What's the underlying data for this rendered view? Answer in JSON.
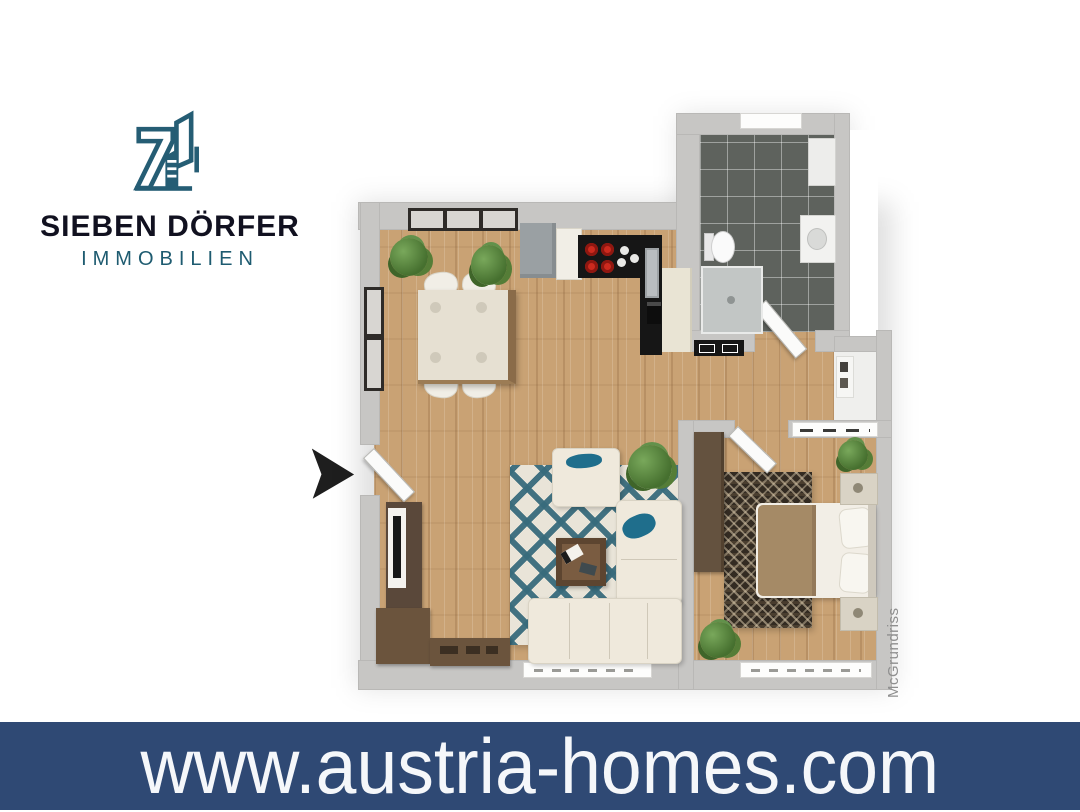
{
  "brand": {
    "name": "SIEBEN DÖRFER",
    "subtitle": "IMMOBILIEN",
    "logo_icon": "seven-buildings-logo-icon",
    "accent_teal": "#255d74",
    "text_dark": "#111120"
  },
  "banner": {
    "url": "www.austria-homes.com",
    "background": "#2f4974",
    "text_color": "#f5f7fa"
  },
  "floorplan": {
    "watermark": "McGrundriss",
    "entrance_icon": "entrance-arrow-icon",
    "colors": {
      "wall_gray": "#c7c6c4",
      "wood_floor": "#c9a274",
      "bathroom_tile": "#5e625d",
      "rug_teal": "#3e7285",
      "kitchen_counter": "#161616",
      "hob_red": "#cc2a1e",
      "dark_wood": "#6b543d"
    }
  }
}
